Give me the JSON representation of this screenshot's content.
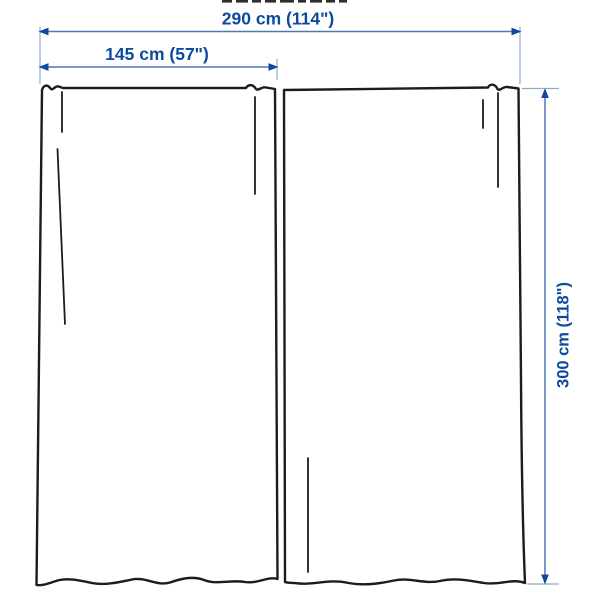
{
  "diagram": {
    "type": "product-dimension-diagram",
    "subject": "two curtain panels with measurement arrows",
    "dimensions": {
      "total_width": "290 cm (114\")",
      "panel_width": "145 cm (57\")",
      "height": "300 cm (118\")"
    }
  },
  "colors": {
    "background": "#ffffff",
    "label_text": "#0b4a9f",
    "dimension_line": "#4d79b5",
    "extension_line": "#90a9ce",
    "arrowhead": "#0d4a9e",
    "outline_color": "#1c1c1c",
    "fragment_color": "#2e2e2e"
  }
}
